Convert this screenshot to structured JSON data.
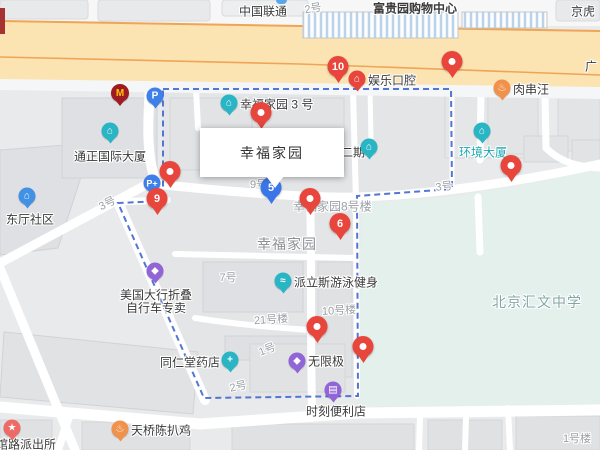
{
  "colors": {
    "marker_red": "#e8453c",
    "marker_blue": "#3b76e8",
    "boundary_blue": "#4a6ed2",
    "road_beige": "#fbe3b2",
    "road_line_orange": "#efa558",
    "campus_green": "#e4f0ec",
    "poi_teal": "#2ab5c4",
    "poi_blue": "#4191e4",
    "poi_purple": "#9265d6",
    "poi_orange": "#f0914c",
    "poi_pink": "#ee6a66",
    "mcdonalds_maroon": "#9e1b23",
    "mcdonalds_yellow": "#ffc500"
  },
  "infobox": {
    "title": "幸福家园"
  },
  "markers": {
    "m10": {
      "label": "10"
    },
    "m_top_corner": {
      "label": ""
    },
    "m_bldg3": {
      "label": ""
    },
    "m_west": {
      "label": ""
    },
    "m9": {
      "label": "9"
    },
    "m5": {
      "label": "5"
    },
    "m_bldg8": {
      "label": ""
    },
    "m6": {
      "label": "6"
    },
    "m_east": {
      "label": ""
    },
    "m_south": {
      "label": ""
    },
    "m_campus": {
      "label": ""
    }
  },
  "pois": {
    "unicom": {
      "label": "中国联通"
    },
    "mall": {
      "label": "富贵园购物中心"
    },
    "jinghu": {
      "label": "京虎"
    },
    "guang": {
      "label": "广"
    },
    "xfjy3": {
      "label": "幸福家园 3 号",
      "glyph": "⌂"
    },
    "yule": {
      "label": "娱乐口腔",
      "glyph": "⌂"
    },
    "rouchuan": {
      "label": "肉串汪",
      "glyph": "♨"
    },
    "tongzheng": {
      "label": "通正国际大厦",
      "glyph": "⌂"
    },
    "dongting": {
      "label": "东厅社区",
      "glyph": "⌂"
    },
    "huanjing": {
      "label": "环境大厦",
      "glyph": "⌂"
    },
    "erqi": {
      "label": "二期",
      "glyph": "⌂"
    },
    "palisi": {
      "label": "派立斯游泳健身",
      "glyph": "≈"
    },
    "dahon": {
      "line1": "美国大行折叠",
      "line2": "自行车专卖",
      "glyph": "◆"
    },
    "tongrentang": {
      "label": "同仁堂药店",
      "glyph": "+"
    },
    "wuxianji": {
      "label": "无限极",
      "glyph": "◆"
    },
    "shike": {
      "label": "时刻便利店",
      "glyph": "▤"
    },
    "tianqiao": {
      "label": "天桥陈扒鸡",
      "glyph": "♨"
    },
    "paichusuo": {
      "label": "馆路派出所",
      "glyph": "★"
    },
    "school": {
      "label": "北京汇文中学"
    },
    "area": {
      "label": "幸福家园"
    },
    "parking1": {
      "glyph": "P"
    },
    "parking2": {
      "glyph": "P+"
    },
    "mcdonalds": {
      "glyph": "M"
    }
  },
  "road_labels": {
    "n2a": "2号",
    "n3a": "3号",
    "n9l": "9号楼",
    "n3b": "3号",
    "n8l": "幸福家园8号楼",
    "n7": "7号",
    "n21": "21号楼",
    "n10l": "10号楼",
    "n1": "1号",
    "n2b": "2号",
    "n1l": "1号楼"
  }
}
